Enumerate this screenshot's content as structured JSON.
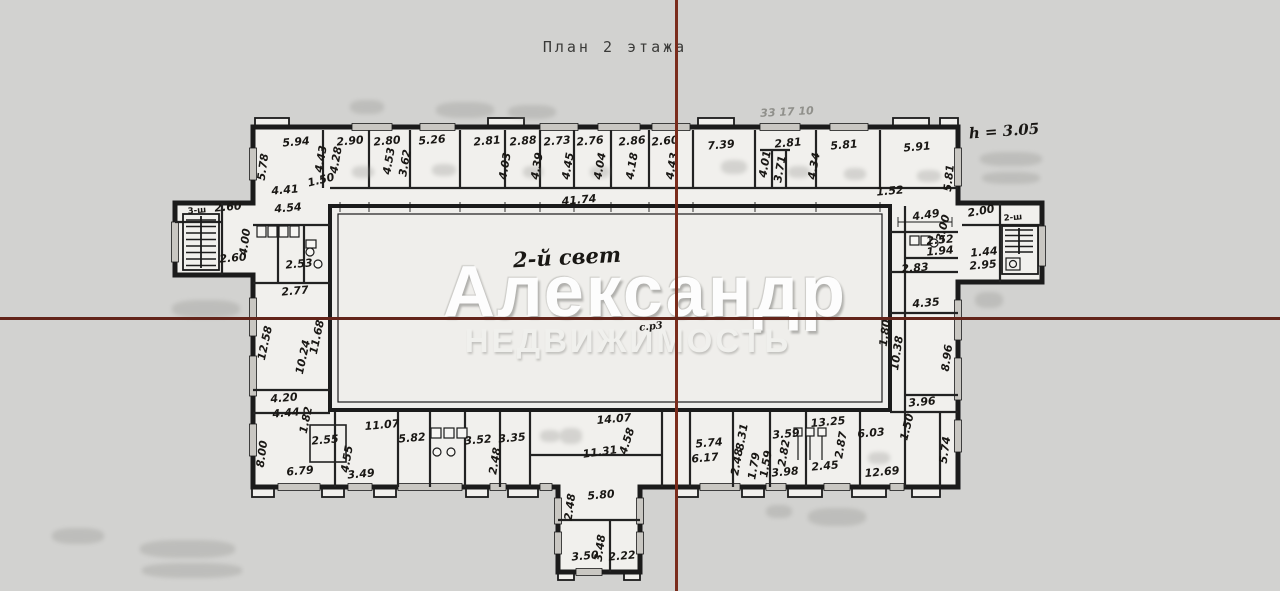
{
  "title": {
    "text": "План 2 этажа"
  },
  "watermark": {
    "line1": "Александр",
    "line2": "НЕДВИЖИМОСТЬ"
  },
  "colors": {
    "background": "#d2d2d0",
    "paper": "#f1f0ed",
    "wall_ink": "#1b1b1b",
    "crosshair_vertical": "#7a2c1c",
    "crosshair_horizontal": "#63241a",
    "watermark": "#ffffff"
  },
  "crosshair": {
    "vertical_x": 675,
    "horizontal_y": 317
  },
  "plan": {
    "labels": [
      {
        "t": "5.94",
        "x": 296,
        "y": 142
      },
      {
        "t": "2.90",
        "x": 350,
        "y": 141
      },
      {
        "t": "2.80",
        "x": 387,
        "y": 141
      },
      {
        "t": "5.26",
        "x": 432,
        "y": 140
      },
      {
        "t": "2.81",
        "x": 487,
        "y": 141
      },
      {
        "t": "2.88",
        "x": 523,
        "y": 141
      },
      {
        "t": "2.73",
        "x": 557,
        "y": 141
      },
      {
        "t": "2.76",
        "x": 590,
        "y": 141
      },
      {
        "t": "2.86",
        "x": 632,
        "y": 141
      },
      {
        "t": "2.60",
        "x": 665,
        "y": 141
      },
      {
        "t": "7.39",
        "x": 721,
        "y": 145
      },
      {
        "t": "2.81",
        "x": 788,
        "y": 143
      },
      {
        "t": "5.81",
        "x": 844,
        "y": 145
      },
      {
        "t": "5.91",
        "x": 917,
        "y": 147
      },
      {
        "t": "5.78",
        "x": 263,
        "y": 167,
        "r": -82
      },
      {
        "t": "4.43",
        "x": 321,
        "y": 159,
        "r": -80
      },
      {
        "t": "4.28",
        "x": 336,
        "y": 160,
        "r": -80
      },
      {
        "t": "4.53",
        "x": 389,
        "y": 161,
        "r": -80
      },
      {
        "t": "3.62",
        "x": 405,
        "y": 163,
        "r": -80
      },
      {
        "t": "4.03",
        "x": 505,
        "y": 166,
        "r": -80
      },
      {
        "t": "4.39",
        "x": 537,
        "y": 166,
        "r": -80
      },
      {
        "t": "4.45",
        "x": 568,
        "y": 166,
        "r": -80
      },
      {
        "t": "4.04",
        "x": 600,
        "y": 166,
        "r": -80
      },
      {
        "t": "4.18",
        "x": 632,
        "y": 166,
        "r": -80
      },
      {
        "t": "4.43",
        "x": 672,
        "y": 166,
        "r": -80
      },
      {
        "t": "4.01",
        "x": 765,
        "y": 164,
        "r": -80
      },
      {
        "t": "3.71",
        "x": 780,
        "y": 169,
        "r": -80
      },
      {
        "t": "4.34",
        "x": 814,
        "y": 166,
        "r": -80
      },
      {
        "t": "5.81",
        "x": 949,
        "y": 178,
        "r": -84
      },
      {
        "t": "4.41",
        "x": 285,
        "y": 190
      },
      {
        "t": "4.54",
        "x": 288,
        "y": 208
      },
      {
        "t": "1.50",
        "x": 321,
        "y": 180,
        "r": -14
      },
      {
        "t": "41.74",
        "x": 579,
        "y": 200
      },
      {
        "t": "1.52",
        "x": 890,
        "y": 191
      },
      {
        "t": "4.49",
        "x": 926,
        "y": 215,
        "r": -8
      },
      {
        "t": "3.00",
        "x": 943,
        "y": 228,
        "r": -76
      },
      {
        "t": "2.52",
        "x": 940,
        "y": 240
      },
      {
        "t": "1.94",
        "x": 940,
        "y": 251
      },
      {
        "t": "2.83",
        "x": 915,
        "y": 268
      },
      {
        "t": "2.00",
        "x": 981,
        "y": 211,
        "r": -10
      },
      {
        "t": "1.44",
        "x": 984,
        "y": 252
      },
      {
        "t": "2.95",
        "x": 983,
        "y": 265
      },
      {
        "t": "4.35",
        "x": 926,
        "y": 303
      },
      {
        "t": "1.80",
        "x": 885,
        "y": 333,
        "r": -82
      },
      {
        "t": "10.38",
        "x": 897,
        "y": 353,
        "r": -82
      },
      {
        "t": "8.96",
        "x": 947,
        "y": 358,
        "r": -82
      },
      {
        "t": "3.96",
        "x": 922,
        "y": 402
      },
      {
        "t": "2.60",
        "x": 228,
        "y": 207
      },
      {
        "t": "4.00",
        "x": 245,
        "y": 242,
        "r": -82
      },
      {
        "t": "2.60",
        "x": 233,
        "y": 258
      },
      {
        "t": "2.53",
        "x": 299,
        "y": 264
      },
      {
        "t": "2.77",
        "x": 295,
        "y": 291
      },
      {
        "t": "12.58",
        "x": 265,
        "y": 343,
        "r": -78
      },
      {
        "t": "11.68",
        "x": 317,
        "y": 337,
        "r": -78
      },
      {
        "t": "10.24",
        "x": 303,
        "y": 357,
        "r": -78
      },
      {
        "t": "4.20",
        "x": 284,
        "y": 398
      },
      {
        "t": "4.44",
        "x": 286,
        "y": 413
      },
      {
        "t": "1.82",
        "x": 306,
        "y": 420,
        "r": -78
      },
      {
        "t": "2.55",
        "x": 325,
        "y": 440
      },
      {
        "t": "8.00",
        "x": 262,
        "y": 454,
        "r": -82
      },
      {
        "t": "6.79",
        "x": 300,
        "y": 471
      },
      {
        "t": "4.55",
        "x": 347,
        "y": 459,
        "r": -80
      },
      {
        "t": "3.49",
        "x": 361,
        "y": 474
      },
      {
        "t": "11.07",
        "x": 382,
        "y": 425
      },
      {
        "t": "5.82",
        "x": 412,
        "y": 438
      },
      {
        "t": "3.52",
        "x": 478,
        "y": 440
      },
      {
        "t": "3.35",
        "x": 512,
        "y": 438
      },
      {
        "t": "2.48",
        "x": 495,
        "y": 461,
        "r": -80
      },
      {
        "t": "14.07",
        "x": 614,
        "y": 419
      },
      {
        "t": "4.58",
        "x": 627,
        "y": 441,
        "r": -72
      },
      {
        "t": "11.31",
        "x": 600,
        "y": 452,
        "r": -8
      },
      {
        "t": "5.74",
        "x": 709,
        "y": 443
      },
      {
        "t": "6.17",
        "x": 705,
        "y": 458
      },
      {
        "t": "8.31",
        "x": 742,
        "y": 437,
        "r": -80
      },
      {
        "t": "2.48",
        "x": 737,
        "y": 462,
        "r": -80
      },
      {
        "t": "1.79",
        "x": 754,
        "y": 466,
        "r": -80
      },
      {
        "t": "1.59",
        "x": 766,
        "y": 464,
        "r": -80
      },
      {
        "t": "3.59",
        "x": 786,
        "y": 434
      },
      {
        "t": "2.82",
        "x": 784,
        "y": 453,
        "r": -80
      },
      {
        "t": "13.25",
        "x": 828,
        "y": 422
      },
      {
        "t": "6.03",
        "x": 871,
        "y": 433
      },
      {
        "t": "2.87",
        "x": 841,
        "y": 445,
        "r": -80
      },
      {
        "t": "2.45",
        "x": 825,
        "y": 466
      },
      {
        "t": "3.98",
        "x": 785,
        "y": 472
      },
      {
        "t": "12.69",
        "x": 882,
        "y": 472
      },
      {
        "t": "1.50",
        "x": 907,
        "y": 427,
        "r": -76
      },
      {
        "t": "5.74",
        "x": 945,
        "y": 450,
        "r": -82
      },
      {
        "t": "5.80",
        "x": 601,
        "y": 495
      },
      {
        "t": "2.48",
        "x": 570,
        "y": 507,
        "r": -82
      },
      {
        "t": "3.48",
        "x": 600,
        "y": 548,
        "r": -82
      },
      {
        "t": "3.50",
        "x": 585,
        "y": 556
      },
      {
        "t": "2.22",
        "x": 622,
        "y": 556
      },
      {
        "t": "3-ш",
        "x": 197,
        "y": 211,
        "c": "small"
      },
      {
        "t": "2-ш",
        "x": 1013,
        "y": 218,
        "c": "small"
      },
      {
        "t": "h = 3.05",
        "x": 1004,
        "y": 131,
        "c": "hand",
        "f": 15,
        "r": -4
      },
      {
        "t": "2-й  свет",
        "x": 567,
        "y": 257,
        "c": "hand",
        "f": 21,
        "r": -3
      },
      {
        "t": "с.р3",
        "x": 651,
        "y": 327,
        "c": "hand",
        "f": 10,
        "r": -6
      },
      {
        "t": "33 17 10",
        "x": 787,
        "y": 112,
        "c": "pencil",
        "f": 11,
        "r": -3
      }
    ]
  }
}
